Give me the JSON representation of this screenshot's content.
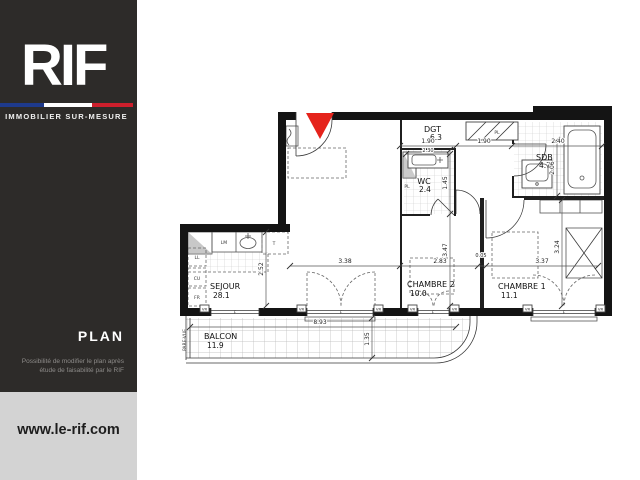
{
  "sidebar": {
    "logo": "RIF",
    "tagline": "IMMOBILIER SUR-MESURE",
    "plan_label": "PLAN",
    "disclaimer_line1": "Possibilité de modifier le plan après",
    "disclaimer_line2": "étude de faisabilité par le RIF",
    "website": "www.le-rif.com",
    "colors": {
      "background": "#2d2b29",
      "footer_background": "#d3d3d3",
      "flag_blue": "#1e3a8c",
      "flag_white": "#ffffff",
      "flag_red": "#cd1f2c"
    }
  },
  "plan": {
    "marker_color": "#e5231b",
    "rooms": {
      "sejour": {
        "name": "SEJOUR",
        "area": "28.1"
      },
      "chambre2": {
        "name": "CHAMBRE 2",
        "area": "10.0"
      },
      "chambre1": {
        "name": "CHAMBRE 1",
        "area": "11.1"
      },
      "wc": {
        "name": "WC",
        "area": "2.4"
      },
      "sdb": {
        "name": "SDB",
        "area": "4.7"
      },
      "dgt": {
        "name": "DGT",
        "area": "6.3"
      },
      "balcon": {
        "name": "BALCON",
        "area": "11.9"
      }
    },
    "dimensions": {
      "dgt_width_left": "1.90",
      "dgt_width_right": "1.90",
      "sdb_width": "2.40",
      "wc_fixture_width": "2.30",
      "wc_depth": "1.45",
      "sdb_depth": "2.06",
      "sejour_width": "3.38",
      "chambre2_width": "2.83",
      "wall_gap": "0.05",
      "chambre1_width": "3.37",
      "chambre2_depth": "3.47",
      "sejour_depth": "2.52",
      "chambre1_depth": "3.24",
      "balcon_width": "8.93",
      "balcon_depth": "1.35"
    },
    "labels": {
      "ll": "LL",
      "cu": "CU",
      "fr": "FR",
      "lm": "LM",
      "table": "T",
      "placard": "PL",
      "shutter": "VR",
      "window": "F",
      "pare_vue": "PARE-VUE"
    }
  }
}
